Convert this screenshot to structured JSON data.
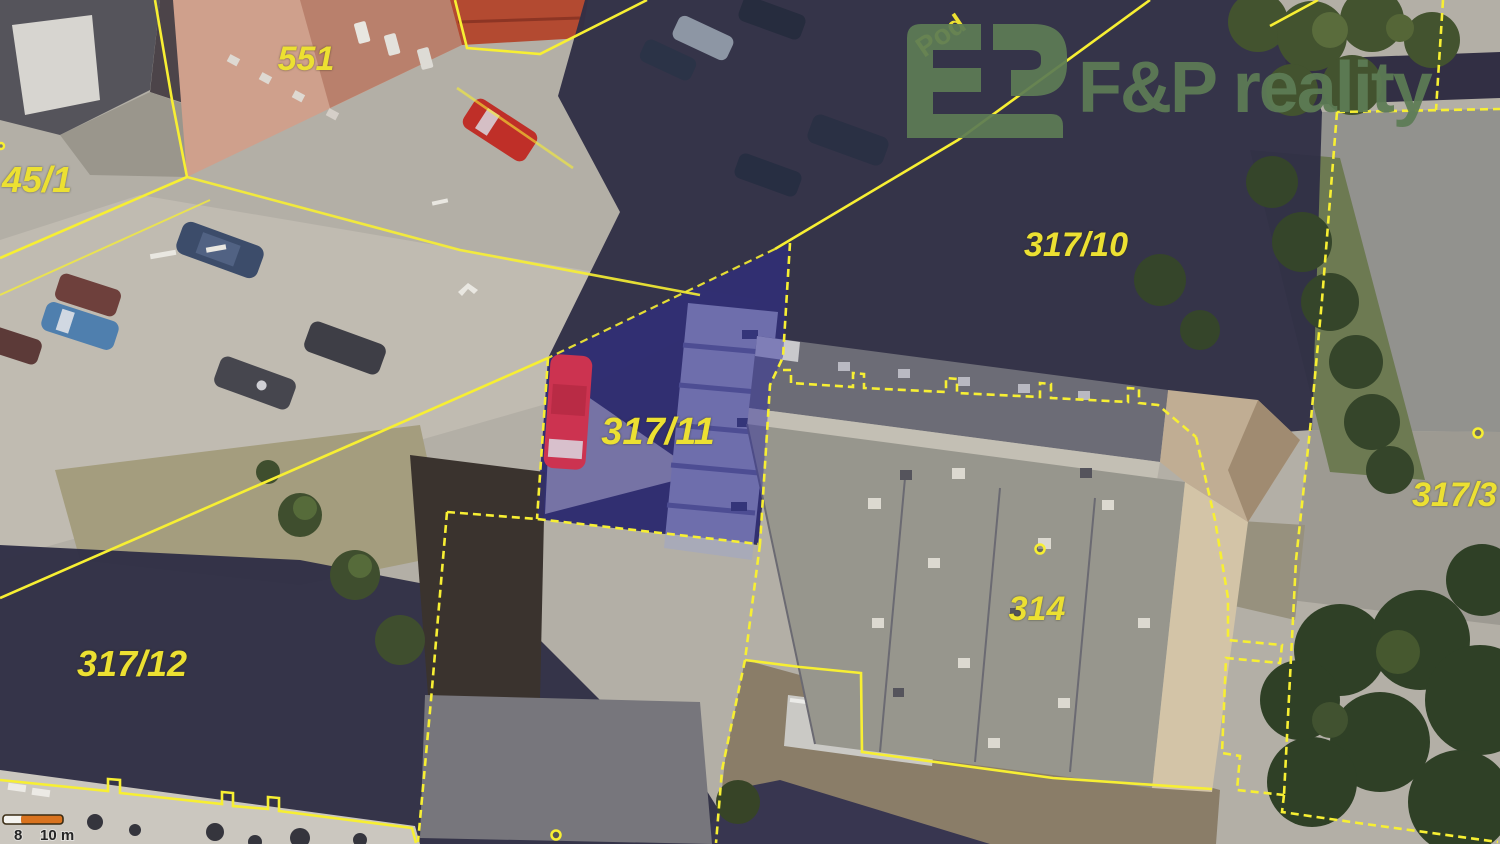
{
  "branding": {
    "logo_text": "F&P reality"
  },
  "map": {
    "street_label": "Pod",
    "highlighted_parcel": "317/11",
    "parcel_labels": {
      "p551": "551",
      "p45_1": "45/1",
      "p317_10": "317/10",
      "p317_11": "317/11",
      "p317_12": "317/12",
      "p314": "314",
      "p317_3": "317/3"
    },
    "scale_bar": {
      "tick": "8",
      "unit": "10 m"
    },
    "colors": {
      "cadastral_line": "#f7ef33",
      "parcel_label": "#ece032",
      "highlight_fill": "#2d2aa0",
      "logo_green": "#5d7c55",
      "scale_orange": "#d9731f",
      "scale_white": "#f5f4f0",
      "scale_text": "#262626"
    }
  }
}
